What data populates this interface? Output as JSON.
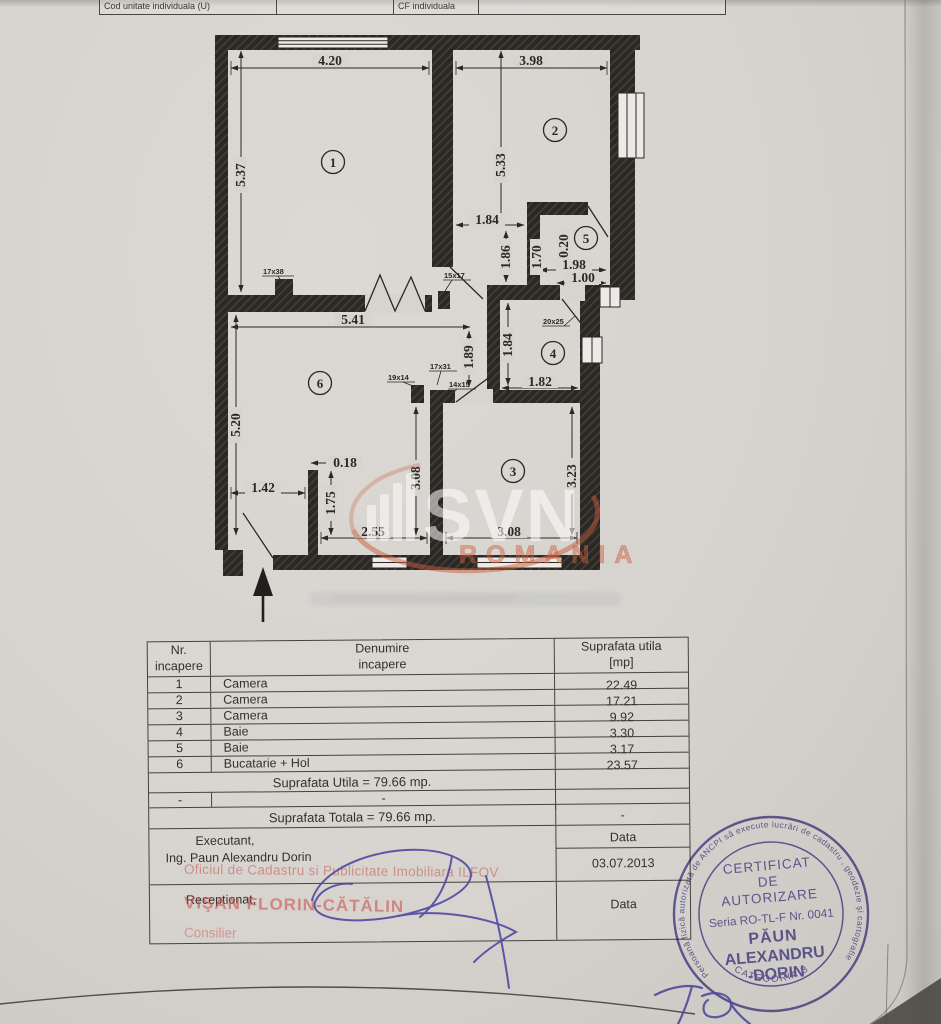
{
  "header": {
    "cell1": "Cod unitate individuala (U)",
    "cell2": "",
    "cell3": "CF individuala",
    "cell4": ""
  },
  "plan": {
    "rooms": [
      "1",
      "2",
      "3",
      "4",
      "5",
      "6"
    ],
    "dims": {
      "dim_420": "4.20",
      "dim_398": "3.98",
      "dim_537": "5.37",
      "dim_533": "5.33",
      "dim_184a": "1.84",
      "dim_186": "1.86",
      "dim_170": "1.70",
      "dim_020": "0.20",
      "dim_198": "1.98",
      "dim_100": "1.00",
      "dim_541": "5.41",
      "dim_189": "1.89",
      "dim_184b": "1.84",
      "dim_182": "1.82",
      "dim_520": "5.20",
      "dim_018": "0.18",
      "dim_142": "1.42",
      "dim_175": "1.75",
      "dim_308v": "3.08",
      "dim_323": "3.23",
      "dim_255": "2.55",
      "dim_308h": "3.08"
    },
    "tags": {
      "t17x38": "17x38",
      "t15x17": "15x17",
      "t19x14": "19x14",
      "t17x31": "17x31",
      "t14x15": "14x15",
      "t20x25": "20x25"
    },
    "watermark": {
      "brand": "SVN",
      "country": "ROMANIA"
    }
  },
  "table": {
    "col1_h1": "Nr.",
    "col1_h2": "incapere",
    "col2_h1": "Denumire",
    "col2_h2": "incapere",
    "col3_h1": "Suprafata utila",
    "col3_h2": "[mp]",
    "rows": [
      {
        "nr": "1",
        "name": "Camera",
        "area": "22.49"
      },
      {
        "nr": "2",
        "name": "Camera",
        "area": "17.21"
      },
      {
        "nr": "3",
        "name": "Camera",
        "area": "9.92"
      },
      {
        "nr": "4",
        "name": "Baie",
        "area": "3.30"
      },
      {
        "nr": "5",
        "name": "Baie",
        "area": "3.17"
      },
      {
        "nr": "6",
        "name": "Bucatarie + Hol",
        "area": "23.57"
      }
    ],
    "utila_total": "Suprafata Utila = 79.66 mp.",
    "dash1": "-",
    "dash2": "-",
    "dash3": "-",
    "totala_total": "Suprafata Totala = 79.66 mp.",
    "executant_label": "Executant,",
    "executant_name": "Ing. Paun Alexandru Dorin",
    "data_label": "Data",
    "date_value": "03.07.2013",
    "receptionat_label": "Receptionat,",
    "data_label2": "Data"
  },
  "overlays": {
    "oficiu": "Oficiul de Cadastru si Publicitate Imobiliara ILFOV",
    "visan": "VIŞAN FLORIN-CĂTĂLIN",
    "consilier": "Consilier"
  },
  "stamp": {
    "ring": "Persoană fizică autorizată de ANCPI să execute lucrări de cadastru , geodezie şi cartografie",
    "l1": "CERTIFICAT",
    "l2": "DE",
    "l3": "AUTORIZARE",
    "l4": "Seria RO-TL-F Nr. 0041",
    "l5": "PĂUN",
    "l6": "ALEXANDRU",
    "l7": "-DORIN",
    "l8": "CATEGORIA B"
  },
  "colors": {
    "stamp_ink": "#5b54a6",
    "overlay_red": "#c9544c",
    "signature_blue": "#4f4aa0",
    "plan_wall": "#2b2723"
  }
}
